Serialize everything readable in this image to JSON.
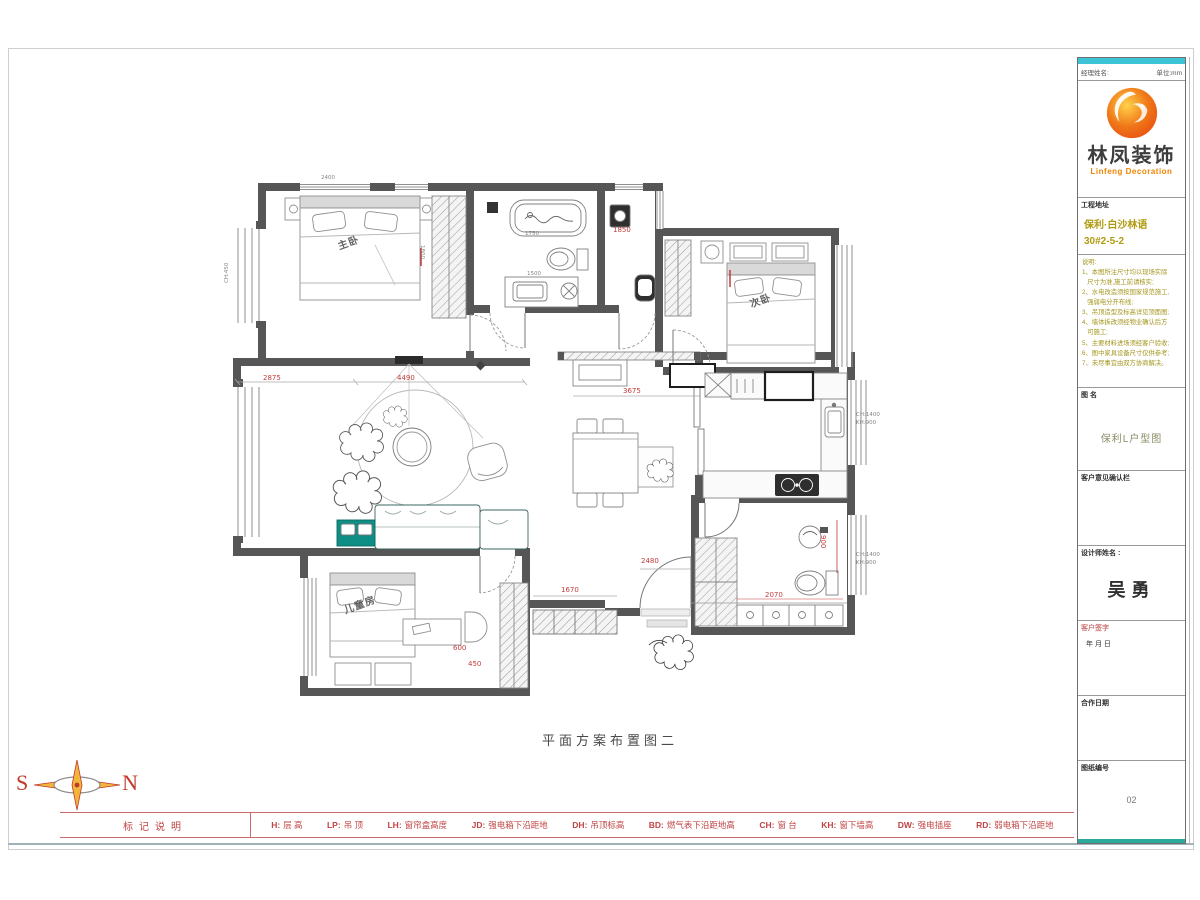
{
  "colors": {
    "wall": "#565656",
    "accent_teal": "#0e8e84",
    "dim_red": "#c23b3b",
    "olive_text": "#a3951c",
    "cyan_bar": "#3cc4d6",
    "logo_orange": "#f08300",
    "legend_red": "#c04545"
  },
  "plan": {
    "title": "平面方案布置图二",
    "labels": [
      {
        "t": "2875",
        "x": 38,
        "y": 200,
        "cls": "red"
      },
      {
        "t": "4490",
        "x": 172,
        "y": 200,
        "cls": "red"
      },
      {
        "t": "3675",
        "x": 398,
        "y": 213,
        "cls": "red"
      },
      {
        "t": "1850",
        "x": 388,
        "y": 52,
        "cls": "red"
      },
      {
        "t": "2480",
        "x": 416,
        "y": 383,
        "cls": "red"
      },
      {
        "t": "1670",
        "x": 336,
        "y": 412,
        "cls": "red"
      },
      {
        "t": "2070",
        "x": 540,
        "y": 417,
        "cls": "red"
      },
      {
        "t": "900",
        "x": 601,
        "y": 360,
        "cls": "red",
        "rot": 90
      },
      {
        "t": "600",
        "x": 228,
        "y": 470,
        "cls": "red"
      },
      {
        "t": "450",
        "x": 243,
        "y": 486,
        "cls": "red"
      },
      {
        "t": "1750",
        "x": 300,
        "y": 57,
        "cls": "dim"
      },
      {
        "t": "1500",
        "x": 302,
        "y": 97,
        "cls": "dim"
      },
      {
        "t": "1800",
        "x": 199,
        "y": 70,
        "cls": "dim",
        "rot": 90
      },
      {
        "t": "2400",
        "x": 96,
        "y": 1,
        "cls": "dim"
      },
      {
        "t": "CH:1400",
        "x": 631,
        "y": 238,
        "cls": "dim"
      },
      {
        "t": "KH:900",
        "x": 631,
        "y": 246,
        "cls": "dim"
      },
      {
        "t": "CH:1400",
        "x": 631,
        "y": 378,
        "cls": "dim"
      },
      {
        "t": "KH:900",
        "x": 631,
        "y": 386,
        "cls": "dim"
      },
      {
        "t": "CH:450",
        "x": 0,
        "y": 108,
        "cls": "dim",
        "rot": -90
      },
      {
        "t": "主卧",
        "x": 112,
        "y": 68,
        "cls": "room",
        "rot": -20
      },
      {
        "t": "次卧",
        "x": 524,
        "y": 126,
        "cls": "room",
        "rot": -20
      },
      {
        "t": "儿童房",
        "x": 118,
        "y": 432,
        "cls": "room",
        "rot": -20
      }
    ]
  },
  "compass": {
    "west": "S",
    "east": "N"
  },
  "legend": {
    "label": "标记说明",
    "items": [
      {
        "code": "H:",
        "text": "层  高"
      },
      {
        "code": "LP:",
        "text": "吊  顶"
      },
      {
        "code": "LH:",
        "text": "窗帘盒高度"
      },
      {
        "code": "JD:",
        "text": "强电箱下沿距地"
      },
      {
        "code": "DH:",
        "text": "吊顶标高"
      },
      {
        "code": "BD:",
        "text": "燃气表下沿距地高"
      },
      {
        "code": "CH:",
        "text": "窗  台"
      },
      {
        "code": "KH:",
        "text": "窗下墙高"
      },
      {
        "code": "DW:",
        "text": "强电插座"
      },
      {
        "code": "RD:",
        "text": "弱电箱下沿距地"
      }
    ]
  },
  "titleblock": {
    "top_row": {
      "left": "经理姓名:",
      "right": "单位:mm"
    },
    "logo": {
      "brand": "林凤装饰",
      "brand_en": "Linfeng Decoration"
    },
    "project": {
      "label": "工程地址",
      "lines": [
        "保利·白沙林语",
        "30#2-5-2"
      ]
    },
    "notes": {
      "label": "说明:",
      "lines": [
        "说明:",
        "1、本图所注尺寸均以现场实际",
        "   尺寸为准,施工前请核实;",
        "2、水电改造须按国家规范施工,",
        "   强弱电分开布线;",
        "3、吊顶造型及标高详见顶面图;",
        "4、墙体拆改须经物业确认后方",
        "   可施工;",
        "5、主要材料进场须经客户验收;",
        "6、图中家具设备尺寸仅供参考;",
        "7、未尽事宜由双方协商解决。"
      ]
    },
    "drawing_name": {
      "label": "图  名",
      "value": "保利L户型图"
    },
    "confirm": {
      "label": "客户意见确认栏"
    },
    "designer": {
      "label": "设计师姓名 :",
      "value": "吴勇"
    },
    "signature": {
      "label": "客户签字",
      "sub": "年        月        日"
    },
    "date": {
      "label": "合作日期"
    },
    "number": {
      "label": "图纸编号",
      "value": "02"
    }
  }
}
